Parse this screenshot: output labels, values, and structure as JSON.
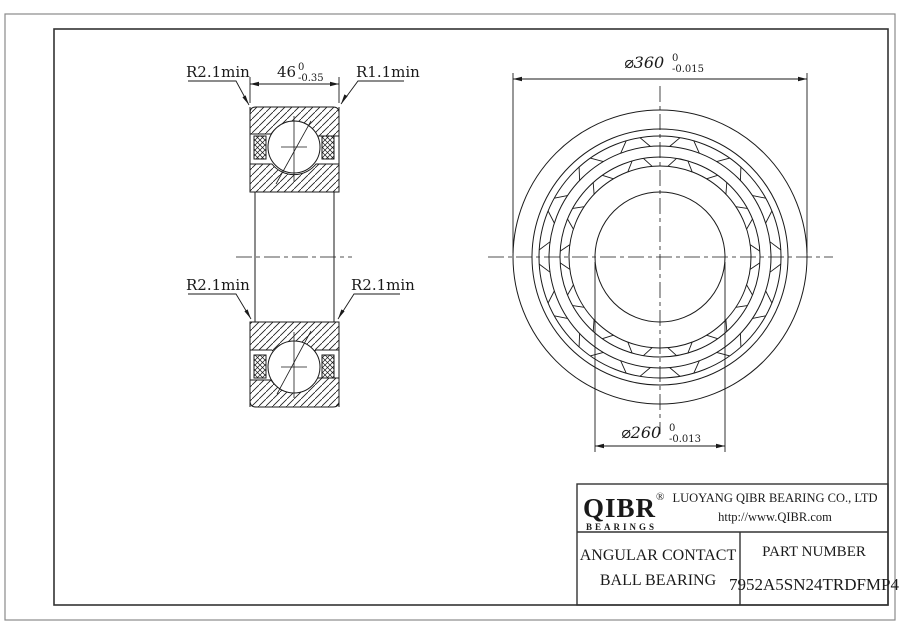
{
  "drawing_labels": {
    "section": {
      "radius_top_left": "R2.1min",
      "radius_top_right": "R1.1min",
      "radius_bottom_left": "R2.1min",
      "radius_bottom_right": "R2.1min",
      "width": {
        "value": "46",
        "tol_upper": "0",
        "tol_lower": "-0.35"
      }
    },
    "front": {
      "outer_diameter": {
        "value": "⌀360",
        "tol_upper": "0",
        "tol_lower": "-0.015"
      },
      "bore_diameter": {
        "value": "⌀260",
        "tol_upper": "0",
        "tol_lower": "-0.013"
      }
    }
  },
  "title_block": {
    "logo": {
      "brand": "QIBR",
      "registered": "®",
      "sub": "BEARINGS"
    },
    "company": "LUOYANG QIBR BEARING CO., LTD",
    "website": "http://www.QIBR.com",
    "product_type_line1": "ANGULAR CONTACT",
    "product_type_line2": "BALL BEARING",
    "part_number_label": "PART NUMBER",
    "part_number": "7952A5SN24TRDFMP4"
  },
  "colors": {
    "line": "#1a1a1a",
    "frame": "#333333",
    "background": "#ffffff"
  }
}
